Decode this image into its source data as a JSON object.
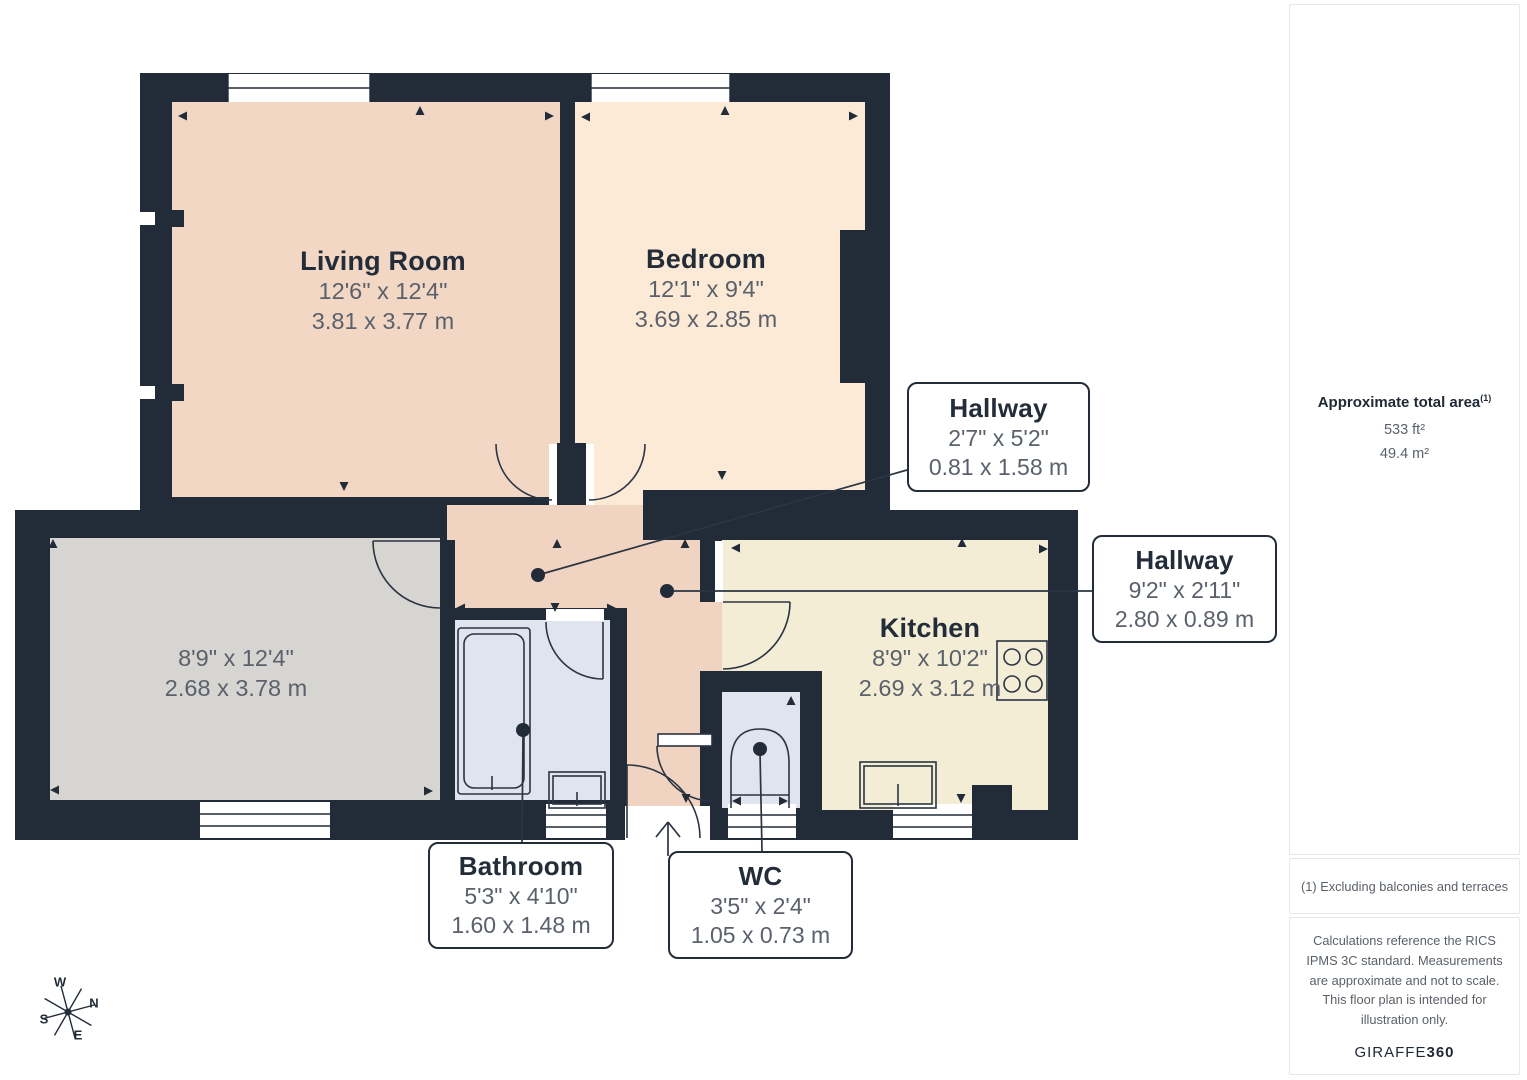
{
  "plan": {
    "rooms": {
      "living_room": {
        "name": "Living Room",
        "dims_ft": "12'6\" x 12'4\"",
        "dims_m": "3.81 x 3.77 m"
      },
      "bedroom": {
        "name": "Bedroom",
        "dims_ft": "12'1\" x 9'4\"",
        "dims_m": "3.69 x 2.85 m"
      },
      "unnamed_room": {
        "name": "",
        "dims_ft": "8'9\" x 12'4\"",
        "dims_m": "2.68 x 3.78 m"
      },
      "kitchen": {
        "name": "Kitchen",
        "dims_ft": "8'9\" x 10'2\"",
        "dims_m": "2.69 x 3.12 m"
      }
    },
    "callouts": {
      "hallway_upper": {
        "name": "Hallway",
        "dims_ft": "2'7\" x 5'2\"",
        "dims_m": "0.81 x 1.58 m"
      },
      "hallway_lower": {
        "name": "Hallway",
        "dims_ft": "9'2\" x 2'11\"",
        "dims_m": "2.80 x 0.89 m"
      },
      "bathroom": {
        "name": "Bathroom",
        "dims_ft": "5'3\" x 4'10\"",
        "dims_m": "1.60 x 1.48 m"
      },
      "wc": {
        "name": "WC",
        "dims_ft": "3'5\" x 2'4\"",
        "dims_m": "1.05 x 0.73 m"
      }
    },
    "compass": {
      "n": "N",
      "e": "E",
      "s": "S",
      "w": "W"
    }
  },
  "sidebar": {
    "area": {
      "title": "Approximate total area",
      "footnote_marker": "(1)",
      "imperial": "533 ft²",
      "metric": "49.4 m²"
    },
    "footnote": "(1) Excluding balconies and terraces",
    "disclaimer": "Calculations reference the RICS IPMS 3C standard. Measurements are approximate and not to scale. This floor plan is intended for illustration only.",
    "brand": {
      "name": "GIRAFFE",
      "suffix": "360"
    }
  },
  "colors": {
    "wall": "#222c39",
    "living_room_fill": "#f2d7c5",
    "bedroom_fill": "#fcead6",
    "hallway_fill": "#f0d3c0",
    "kitchen_fill": "#f4edd6",
    "unnamed_room_fill": "#d6d5d2",
    "bathroom_fill": "#e0e4ef",
    "label_title": "#232c39",
    "label_dims": "#5a616b"
  }
}
